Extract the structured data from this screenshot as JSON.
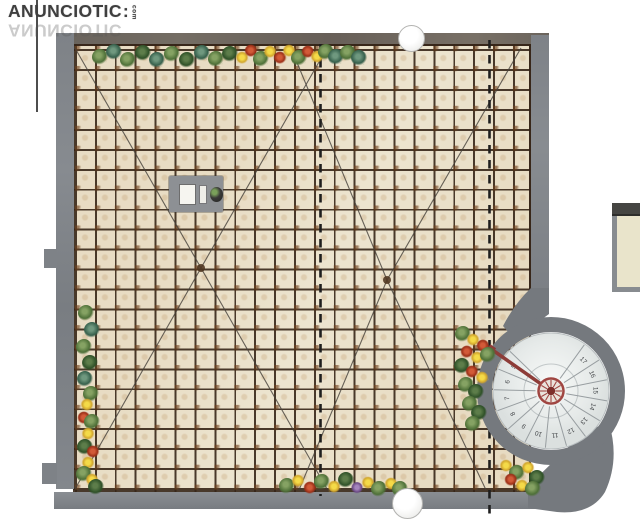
{
  "watermark": {
    "brand": "ANUNCIOTIC",
    "colon": ":",
    "domain": "com"
  },
  "palette": {
    "tile": "#ece4cf",
    "grout": "#36261a",
    "wall": "#7e8287",
    "wall_dark": "#68625b",
    "stair_ring": "#75797e",
    "stair_floor": "#e4e8e7",
    "accent_red": "#8d3c38",
    "hub_red": "#a04642",
    "dash": "#1e1e1e",
    "slope_line": "#45403a",
    "drain": "#4e3520"
  },
  "stair": {
    "steps": [
      "5",
      "6",
      "7",
      "8",
      "9",
      "10",
      "11",
      "12",
      "13",
      "14",
      "15",
      "16",
      "17"
    ],
    "center": [
      551,
      391
    ],
    "radius_outer": 73,
    "radius_floor": 58,
    "start_angle": 224,
    "step_angle": -21.4,
    "rail_angle": 215
  },
  "drains": [
    [
      201,
      268
    ],
    [
      387,
      280
    ]
  ],
  "expansion_joints": [
    {
      "x": 320.5,
      "y1": 44,
      "y2": 496
    },
    {
      "x": 489.5,
      "y1": 40,
      "y2": 514
    }
  ],
  "slope_lines": [
    [
      75,
      48,
      201,
      268
    ],
    [
      327,
      48,
      201,
      268
    ],
    [
      75,
      489,
      201,
      268
    ],
    [
      327,
      489,
      201,
      268
    ],
    [
      291,
      48,
      387,
      280
    ],
    [
      521,
      48,
      387,
      280
    ],
    [
      299,
      490,
      387,
      280
    ],
    [
      486,
      490,
      387,
      280
    ]
  ],
  "plants": [
    [
      100,
      57,
      "g"
    ],
    [
      114,
      52,
      "t"
    ],
    [
      128,
      60,
      "g"
    ],
    [
      143,
      53,
      "d"
    ],
    [
      157,
      60,
      "t"
    ],
    [
      172,
      54,
      "g"
    ],
    [
      187,
      60,
      "d"
    ],
    [
      202,
      53,
      "t"
    ],
    [
      216,
      59,
      "g"
    ],
    [
      230,
      54,
      "d"
    ],
    [
      242,
      58,
      "y"
    ],
    [
      251,
      51,
      "r"
    ],
    [
      261,
      59,
      "g"
    ],
    [
      270,
      52,
      "y"
    ],
    [
      280,
      58,
      "r"
    ],
    [
      289,
      51,
      "y"
    ],
    [
      299,
      58,
      "g"
    ],
    [
      308,
      52,
      "r"
    ],
    [
      317,
      57,
      "y"
    ],
    [
      326,
      52,
      "g"
    ],
    [
      336,
      57,
      "t"
    ],
    [
      348,
      53,
      "g"
    ],
    [
      359,
      58,
      "t"
    ],
    [
      86,
      313,
      "g"
    ],
    [
      92,
      330,
      "t"
    ],
    [
      84,
      347,
      "g"
    ],
    [
      90,
      363,
      "d"
    ],
    [
      85,
      379,
      "t"
    ],
    [
      91,
      394,
      "g"
    ],
    [
      87,
      405,
      "y"
    ],
    [
      84,
      418,
      "r"
    ],
    [
      92,
      422,
      "g"
    ],
    [
      88,
      434,
      "y"
    ],
    [
      85,
      447,
      "d"
    ],
    [
      93,
      452,
      "r"
    ],
    [
      88,
      463,
      "y"
    ],
    [
      84,
      474,
      "g"
    ],
    [
      92,
      480,
      "y"
    ],
    [
      96,
      487,
      "d"
    ],
    [
      287,
      486,
      "g"
    ],
    [
      298,
      481,
      "y"
    ],
    [
      310,
      488,
      "r"
    ],
    [
      322,
      482,
      "g"
    ],
    [
      334,
      487,
      "y"
    ],
    [
      346,
      480,
      "d"
    ],
    [
      357,
      488,
      "p"
    ],
    [
      368,
      483,
      "y"
    ],
    [
      379,
      489,
      "g"
    ],
    [
      391,
      484,
      "y"
    ],
    [
      400,
      489,
      "g"
    ],
    [
      463,
      334,
      "g"
    ],
    [
      473,
      340,
      "y"
    ],
    [
      483,
      346,
      "r"
    ],
    [
      467,
      352,
      "r"
    ],
    [
      477,
      358,
      "y"
    ],
    [
      488,
      355,
      "g"
    ],
    [
      462,
      366,
      "d"
    ],
    [
      472,
      372,
      "r"
    ],
    [
      482,
      378,
      "y"
    ],
    [
      466,
      385,
      "g"
    ],
    [
      476,
      392,
      "d"
    ],
    [
      470,
      404,
      "g"
    ],
    [
      479,
      413,
      "d"
    ],
    [
      473,
      424,
      "g"
    ],
    [
      506,
      466,
      "y"
    ],
    [
      517,
      473,
      "g"
    ],
    [
      528,
      468,
      "y"
    ],
    [
      537,
      478,
      "d"
    ],
    [
      511,
      480,
      "r"
    ],
    [
      522,
      486,
      "y"
    ],
    [
      533,
      489,
      "g"
    ]
  ]
}
